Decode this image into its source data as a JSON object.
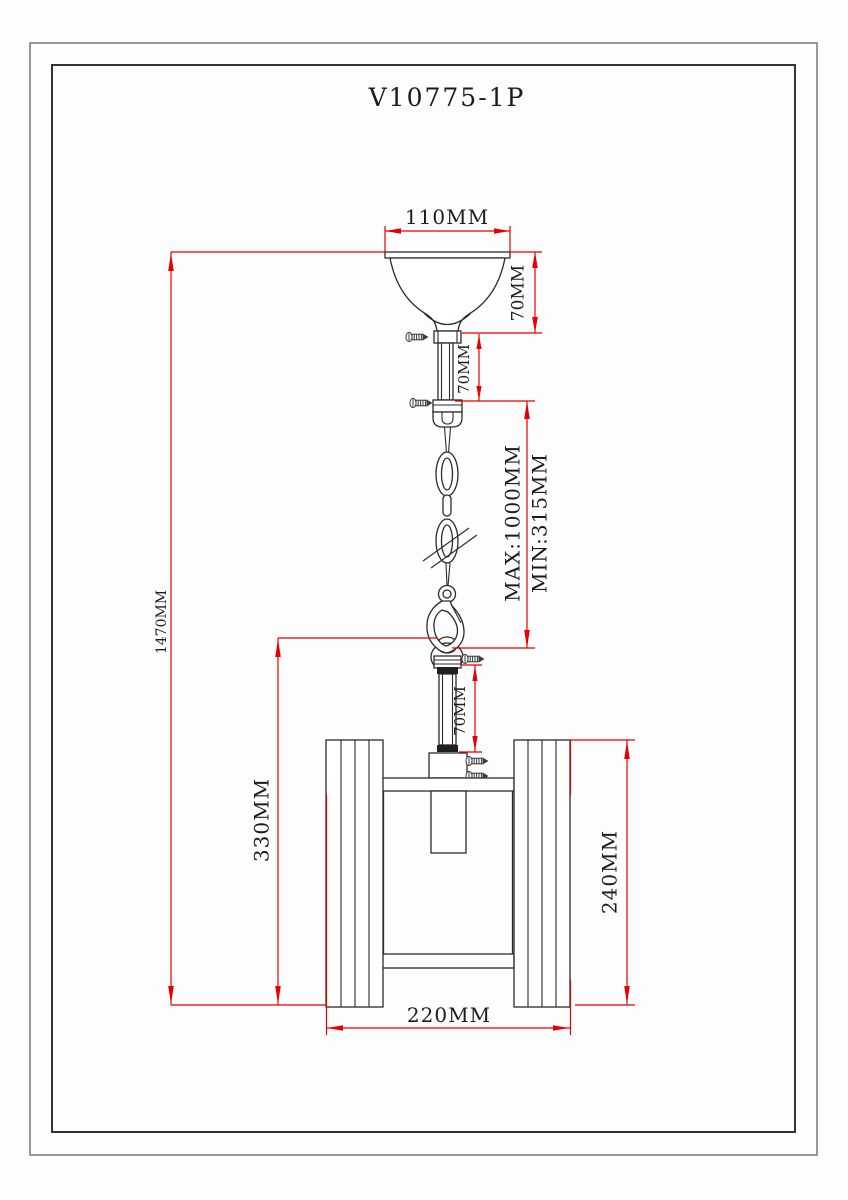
{
  "drawing": {
    "title": "V10775-1P",
    "units": "MM",
    "dimensions": {
      "canopy_width": "110MM",
      "canopy_height": "70MM",
      "upper_rod_length": "70MM",
      "chain_max": "MAX:1000MM",
      "chain_min": "MIN:315MM",
      "overall_height": "1470MM",
      "body_height": "330MM",
      "lower_rod_length": "70MM",
      "shade_height": "240MM",
      "body_width": "220MM"
    },
    "colors": {
      "dimension_line": "#e60000",
      "drawing_line": "#2b2b2b",
      "background": "#ffffff"
    }
  }
}
